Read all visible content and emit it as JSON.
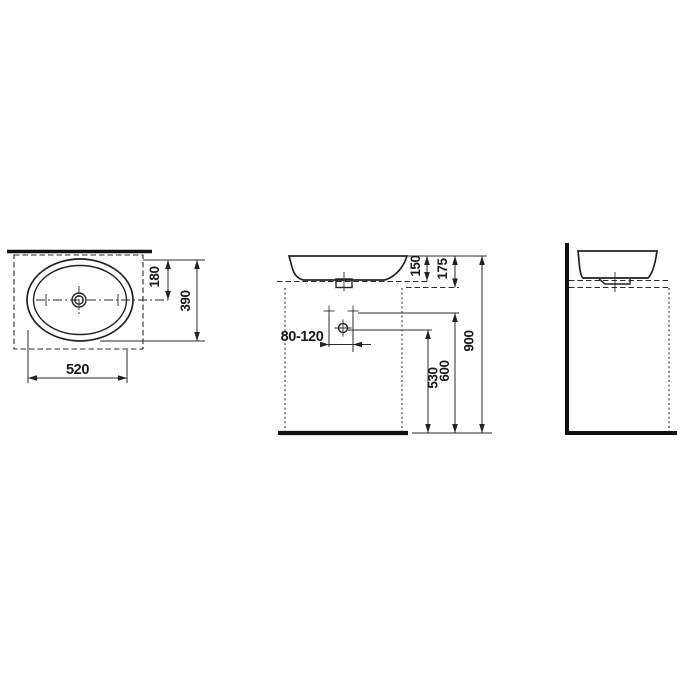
{
  "labels": {
    "top_view": {
      "width": "520",
      "depth": "390",
      "rear_to_center": "180"
    },
    "front_view": {
      "bowl_height": "150",
      "rim_offset": "175",
      "tap_range": "80-120",
      "drain_height": "530",
      "supply_height": "600",
      "rim_height": "900"
    }
  }
}
